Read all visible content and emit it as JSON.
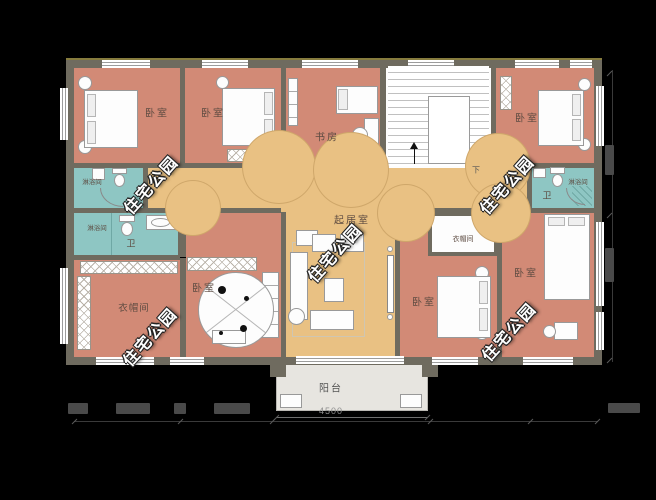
{
  "watermark": {
    "text": "住宅公园"
  },
  "rooms": {
    "bedroom_top_left": {
      "label": "卧室"
    },
    "bedroom_top_mid": {
      "label": "卧室"
    },
    "study": {
      "label": "书房"
    },
    "bedroom_top_right": {
      "label": "卧室"
    },
    "shower_upper_left": {
      "label": "淋浴间"
    },
    "bath_left": {
      "label": "卫",
      "shower_label": "淋浴间"
    },
    "bath_right": {
      "label": "卫",
      "shower_label": "淋浴间"
    },
    "living_room": {
      "label": "起居室"
    },
    "closet_left": {
      "label": "衣帽间"
    },
    "bedroom_mid_left": {
      "label": "卧室"
    },
    "bedroom_mid_right": {
      "label": "卧室",
      "closet_label": "衣帽间"
    },
    "bedroom_bottom_right": {
      "label": "卧室"
    },
    "balcony": {
      "label": "阳台"
    }
  },
  "stairs": {
    "down_label": "下"
  },
  "dimensions": {
    "balcony_width": "4500"
  },
  "colors": {
    "background": "#000000",
    "wall": "#6f6b5f",
    "bedroom_fill": "#d28a76",
    "hall_fill": "#e9c183",
    "bathroom_fill": "#8ec6c3",
    "balcony_fill": "#e7e5e0"
  }
}
